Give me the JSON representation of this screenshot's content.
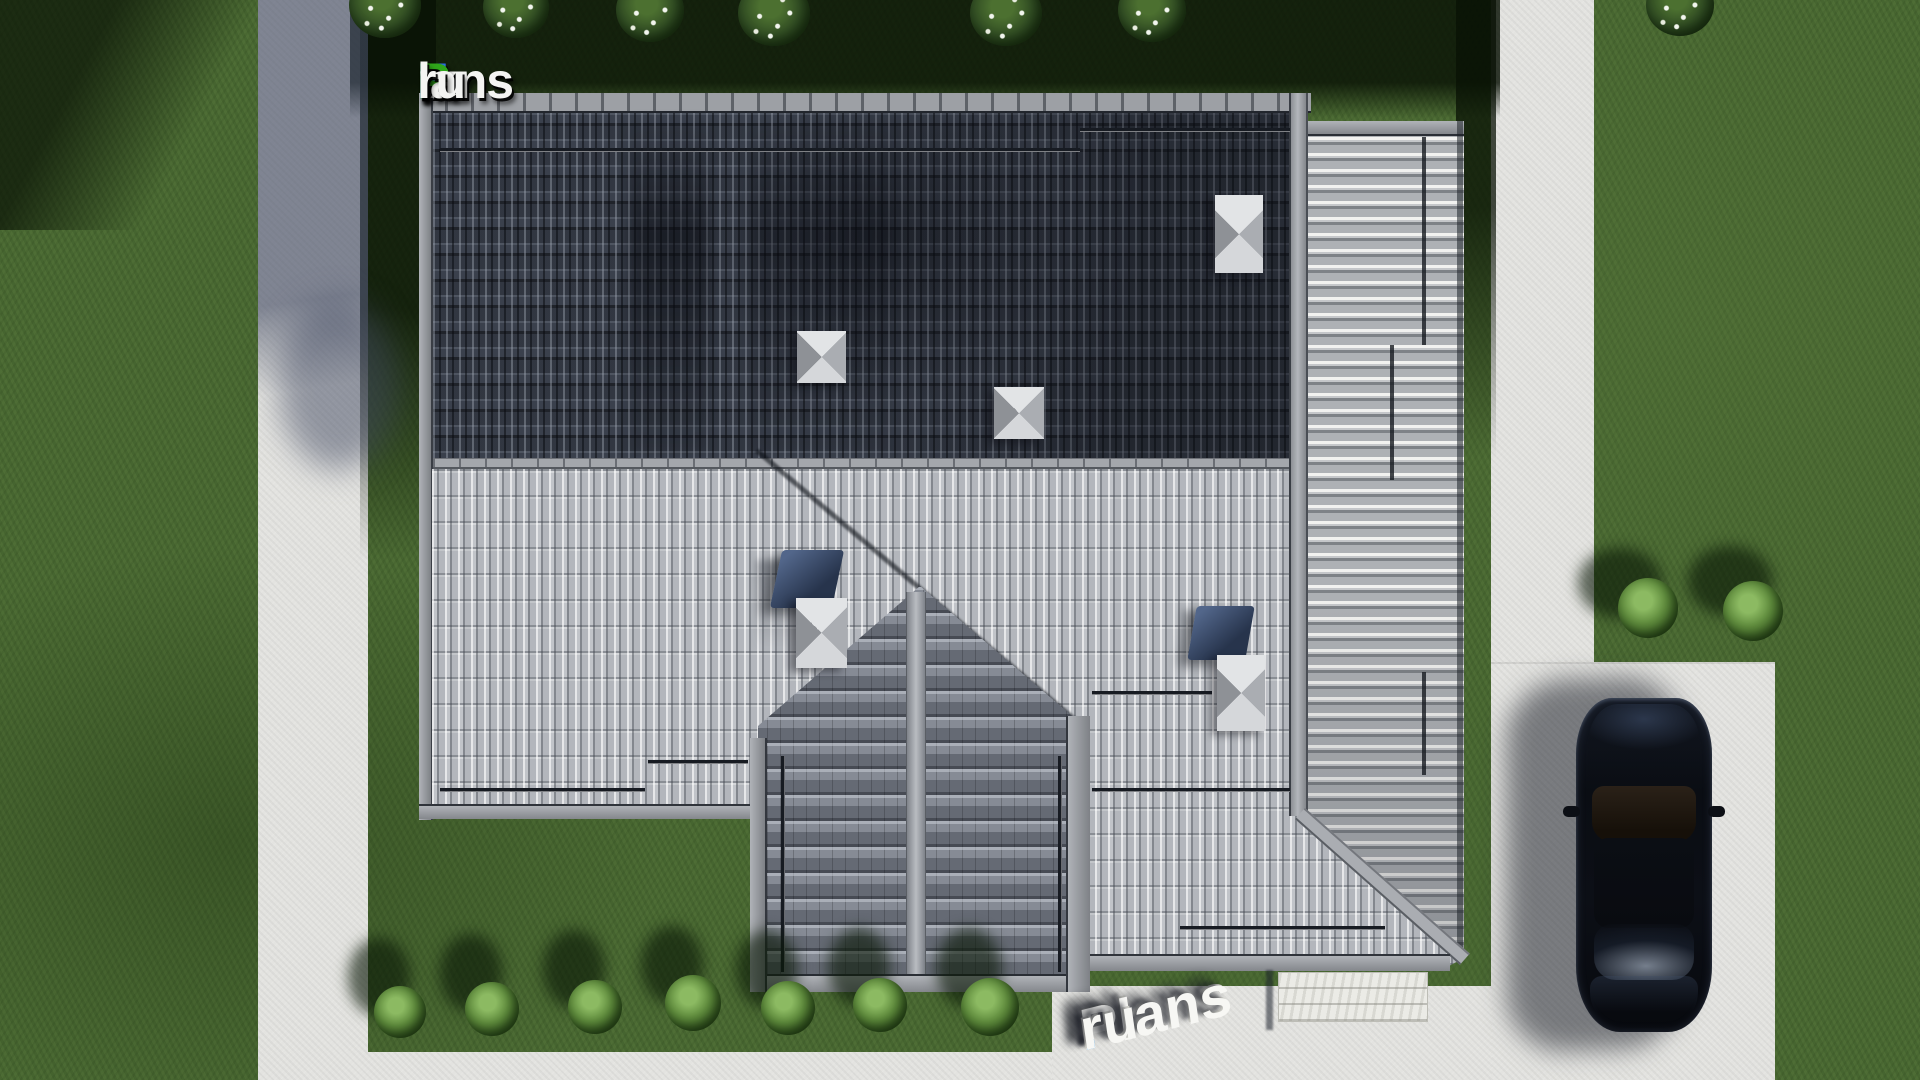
{
  "title": "FixPlans.ru — top-down 3D render of a house roof plan with yard, paths and parked car",
  "logo": {
    "text": "FixPlans.ru",
    "parts": [
      {
        "text": "F",
        "color": "#2b6fe0"
      },
      {
        "text": "ix",
        "color": "#f4f4f2"
      },
      {
        "text": "P",
        "color": "#2fa51a"
      },
      {
        "text": "lans",
        "color": "#f4f4f2"
      },
      {
        "text": ".",
        "color": "#2b6fe0"
      },
      {
        "text": "ru",
        "color": "#f4f4f2"
      }
    ]
  },
  "watermark": {
    "text": "Plans.ru",
    "parts": [
      {
        "text": "Plans",
        "color": "#f7f7f4"
      },
      {
        "text": ".",
        "color": "#2196f3"
      },
      {
        "text": "ru",
        "color": "#f7f7f4"
      }
    ]
  },
  "scene": {
    "colors": {
      "grass": "#4c6c34",
      "grass_shadow": "#16270e",
      "concrete_path": "#e3e3e0",
      "path_in_shadow": "#8f95a6",
      "roof_dark_slope": "#3a404c",
      "roof_light_slope": "#c1c4c9",
      "roof_gable_wing": "#878c96",
      "roof_battens_wing": "#b4b7bb",
      "ridge_cap": "#a4a7ac",
      "chimney": "#c6c9cd",
      "vent_flue": "#39486a",
      "car_body": "#0b0e14",
      "stone_terrace": "#ebebe6"
    },
    "objects": [
      "house main roof (dark north slope, light south slope)",
      "right battened wing roof with hip",
      "bottom cross-gable wing",
      "two pyramid skylights on dark slope",
      "chimneys with metal flues",
      "snow-guard rails",
      "left concrete walkway",
      "right concrete walkway and driveway",
      "stone terrace pad",
      "dark sedan parked on driveway",
      "flowering bushes along top edge",
      "bush row along bottom lawn",
      "two bushes beside driveway"
    ]
  }
}
